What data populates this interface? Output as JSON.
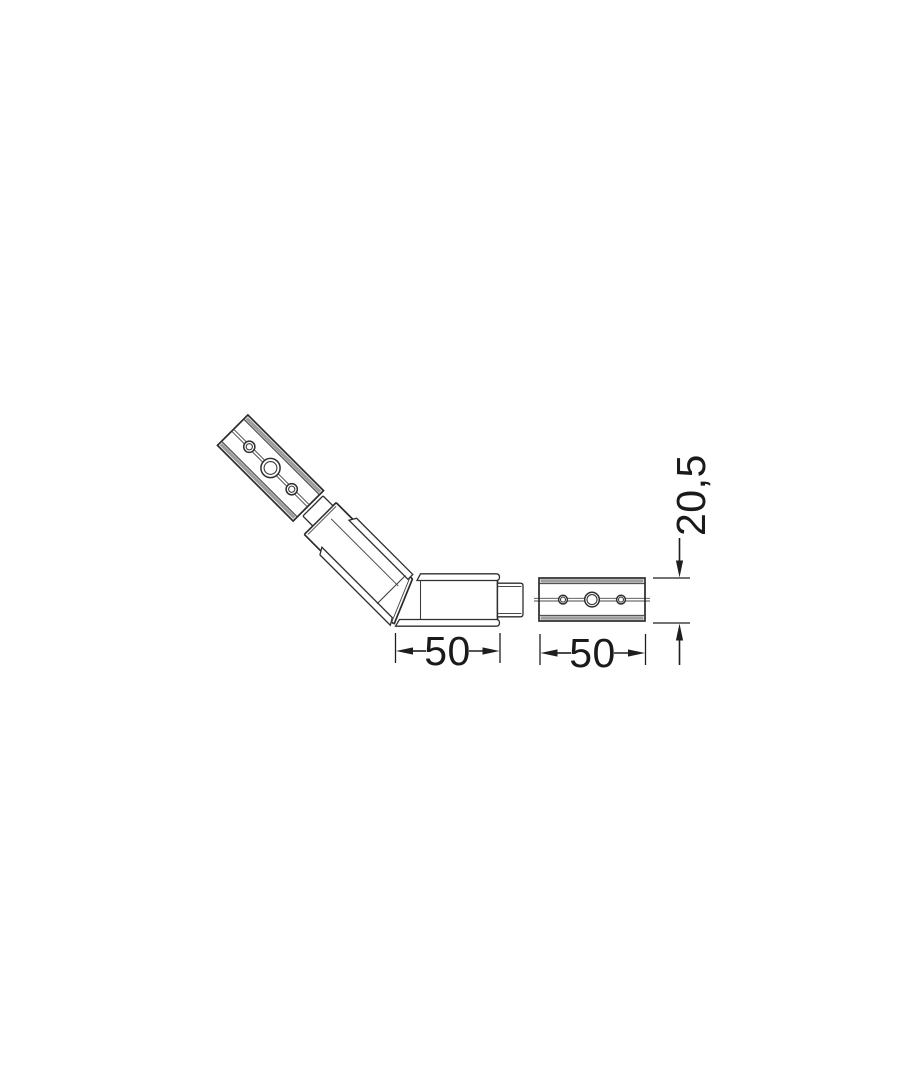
{
  "canvas": {
    "width": 910,
    "height": 1080,
    "background": "#ffffff"
  },
  "colors": {
    "line": "#2a2a2a",
    "shading_gray": "#9e9e9e",
    "dimension_line": "#1e1e1e",
    "fill": "#ffffff"
  },
  "drawing": {
    "type": "technical-diagram",
    "subject": "135-degree corner connector joining two aluminium profile segments, each with three mounting holes",
    "pieces": [
      {
        "id": "profile-segment-angled",
        "description": "angled profile segment with three mounting holes"
      },
      {
        "id": "corner-connector",
        "description": "135-degree elbow connector with side rails and insert tongues"
      },
      {
        "id": "profile-segment-right",
        "description": "horizontal profile segment with three mounting holes"
      }
    ],
    "dims": {
      "left": {
        "label": "50"
      },
      "right": {
        "label": "50"
      },
      "height": {
        "label": "20,5"
      }
    }
  }
}
